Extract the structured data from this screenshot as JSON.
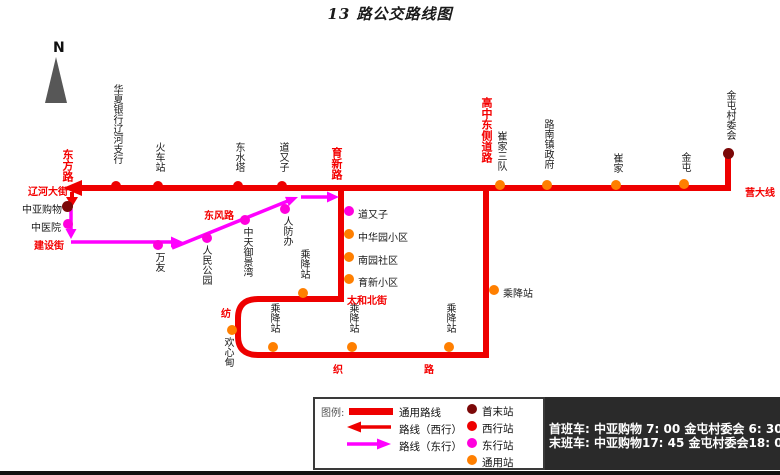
{
  "title": "13 路公交路线图",
  "compass": {
    "label": "N"
  },
  "colors": {
    "route_red": "#ee0000",
    "route_east_magenta": "#ff00ff",
    "station_terminal": "#7b0808",
    "station_west": "#ee0000",
    "station_east": "#ff00dd",
    "station_general": "#ff7f00",
    "schedule_bg": "#2a2a2a"
  },
  "roads": {
    "dongfang": "东方路",
    "liaohe_dajie": "辽河大街",
    "jianshe_jie": "建设街",
    "dongfeng": "东风路",
    "yuxin": "育新路",
    "gaozhong_dongce": "高中东侧道路",
    "taihe_beijie": "太和北街",
    "fangzhi_char1": "纺",
    "fangzhi_char2": "织",
    "fangzhi_char3": "路",
    "yingda_xian": "营大线"
  },
  "stations": {
    "huaxia": "华夏银行辽河支行",
    "huochezhan": "火车站",
    "dongshuita": "东水塔",
    "daoyouzi_w": "道又子",
    "cuijiasandui": "崔家三队",
    "lunanzhenzhengfu": "路南镇政府",
    "cuijia": "崔家",
    "jintun": "金屯",
    "jintuncunweihui": "金屯村委会",
    "zhongyagouwu": "中亚购物",
    "zhongyiyuan": "中医院",
    "wanyou": "万友",
    "renmingongyuan": "人民公园",
    "zhongtianyujingwan": "中天御景湾",
    "renfangban": "人防办",
    "daoyouzi_e": "道又子",
    "zhonghuayuanxiaoqu": "中华园小区",
    "nanyuanshequ": "南园社区",
    "yuxinxiaoqu": "育新小区",
    "chengjiang1": "乘降站",
    "chengjiang2": "乘降站",
    "chengjiang3": "乘降站",
    "chengjiang4": "乘降站",
    "chengjiang5": "乘降站",
    "huanxindian": "欢心甸"
  },
  "legend": {
    "title": "图例:",
    "general_route": "通用路线",
    "west_route": "路线（西行）",
    "east_route": "路线（东行）",
    "terminal_station": "首末站",
    "west_station": "西行站",
    "east_station": "东行站",
    "general_station": "通用站"
  },
  "schedule": {
    "line1": "首班车: 中亚购物 7: 00  金屯村委会 6: 30",
    "line2": "末班车: 中亚购物17: 45  金屯村委会18: 00"
  }
}
